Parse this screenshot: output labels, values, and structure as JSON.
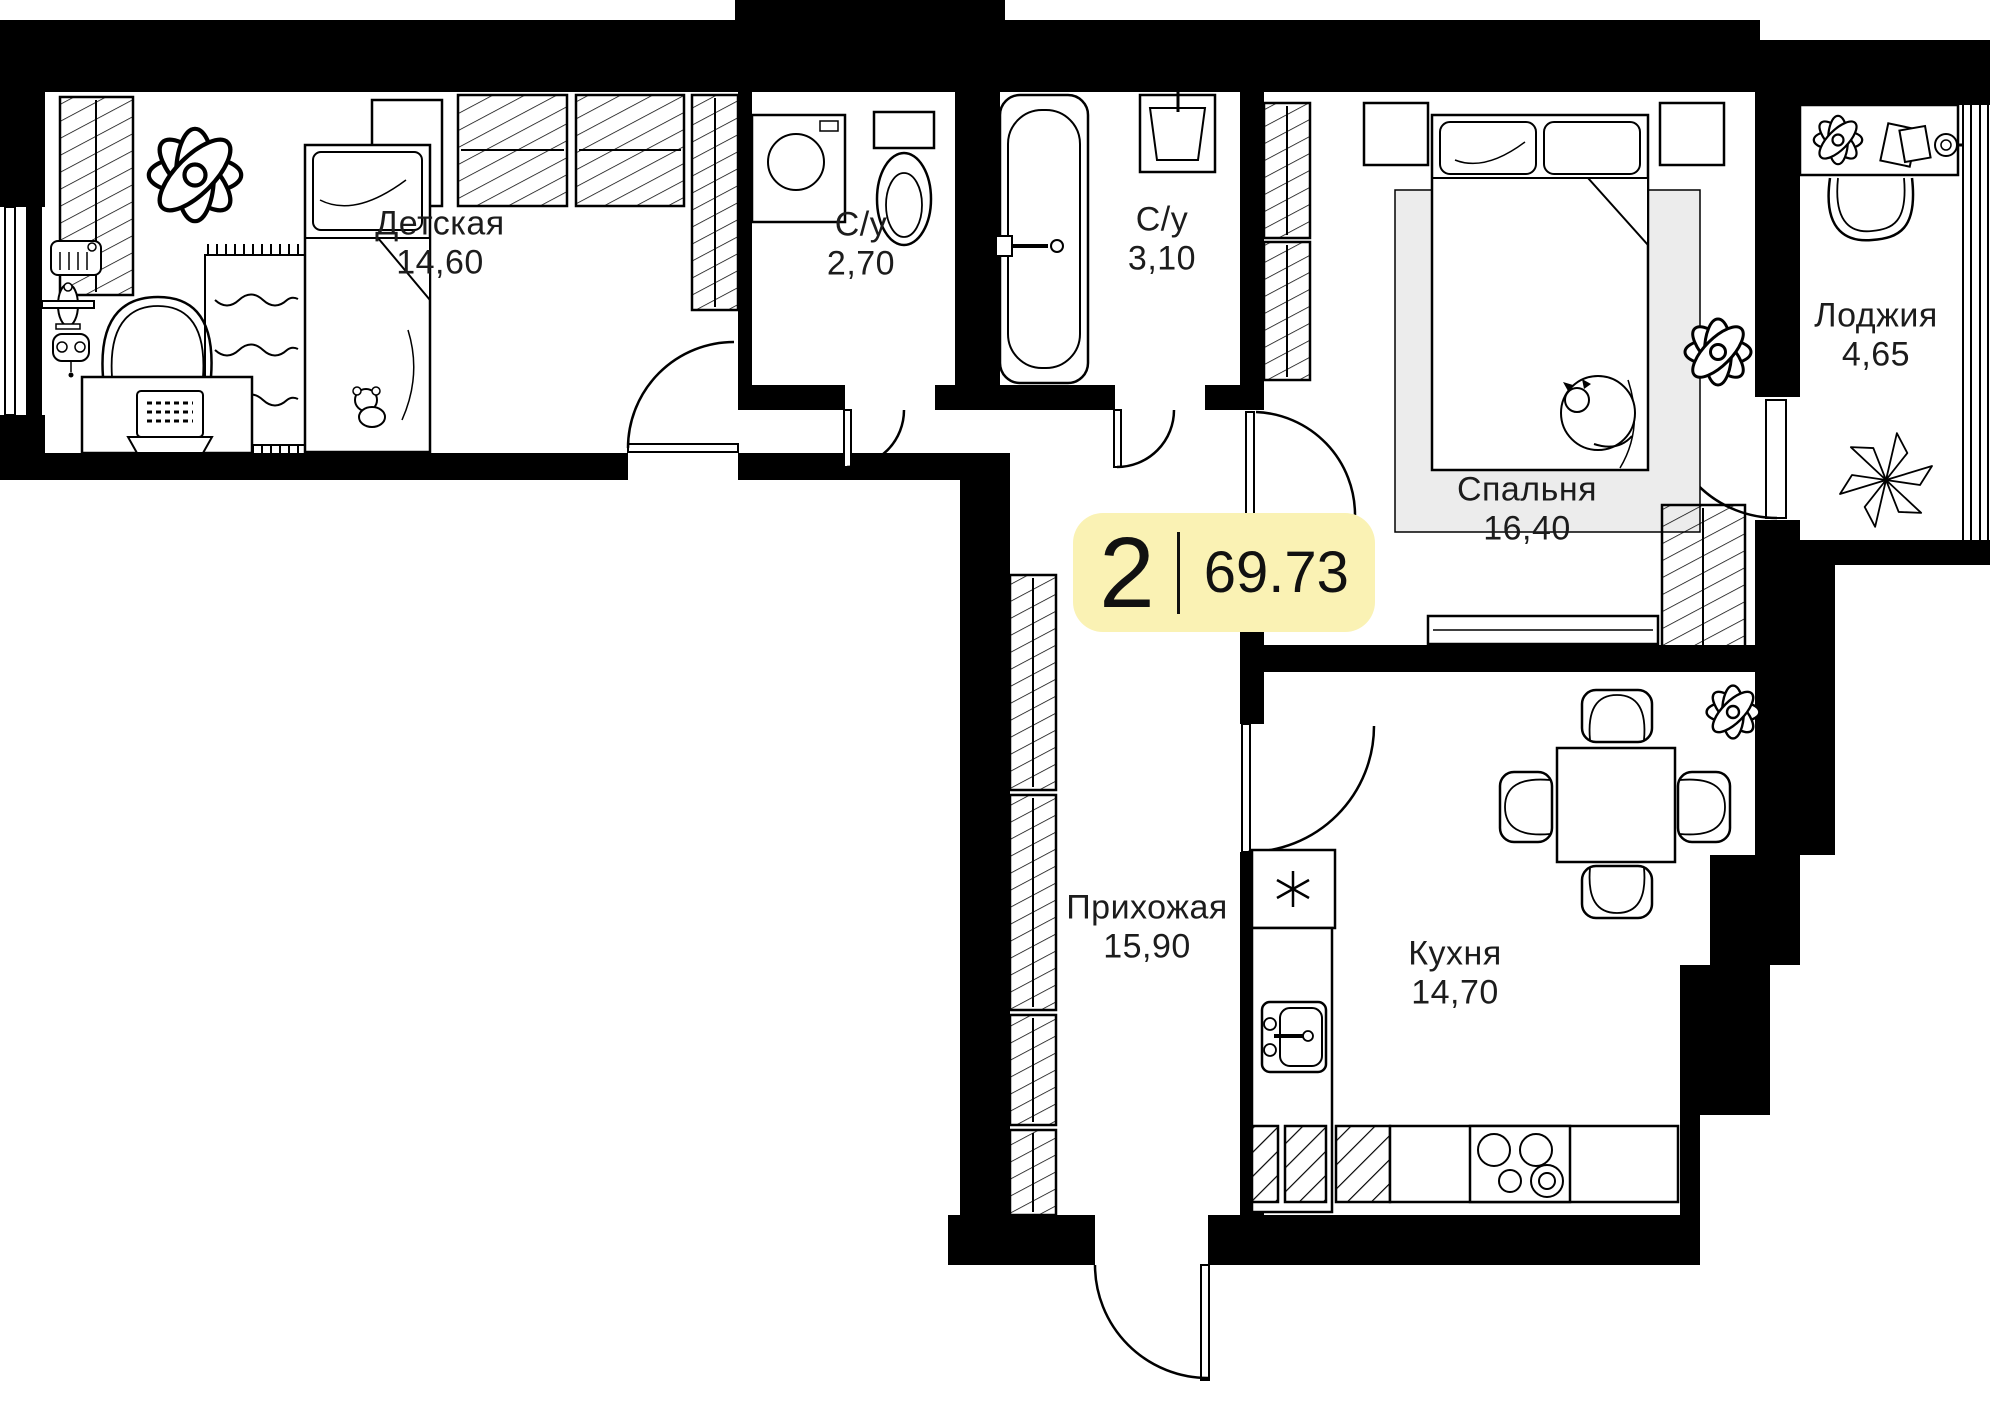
{
  "plan": {
    "badge": {
      "rooms_count": "2",
      "total_area": "69.73"
    },
    "rooms": [
      {
        "id": "children",
        "name": "Детская",
        "area": "14,60"
      },
      {
        "id": "wc1",
        "name": "С/у",
        "area": "2,70"
      },
      {
        "id": "wc2",
        "name": "С/у",
        "area": "3,10"
      },
      {
        "id": "bedroom",
        "name": "Спальня",
        "area": "16,40"
      },
      {
        "id": "loggia",
        "name": "Лоджия",
        "area": "4,65"
      },
      {
        "id": "hall",
        "name": "Прихожая",
        "area": "15,90"
      },
      {
        "id": "kitchen",
        "name": "Кухня",
        "area": "14,70"
      }
    ],
    "colors": {
      "wall": "#000000",
      "badge_bg": "#FAF2B4",
      "rug": "#ECECEC",
      "line": "#000000"
    }
  }
}
